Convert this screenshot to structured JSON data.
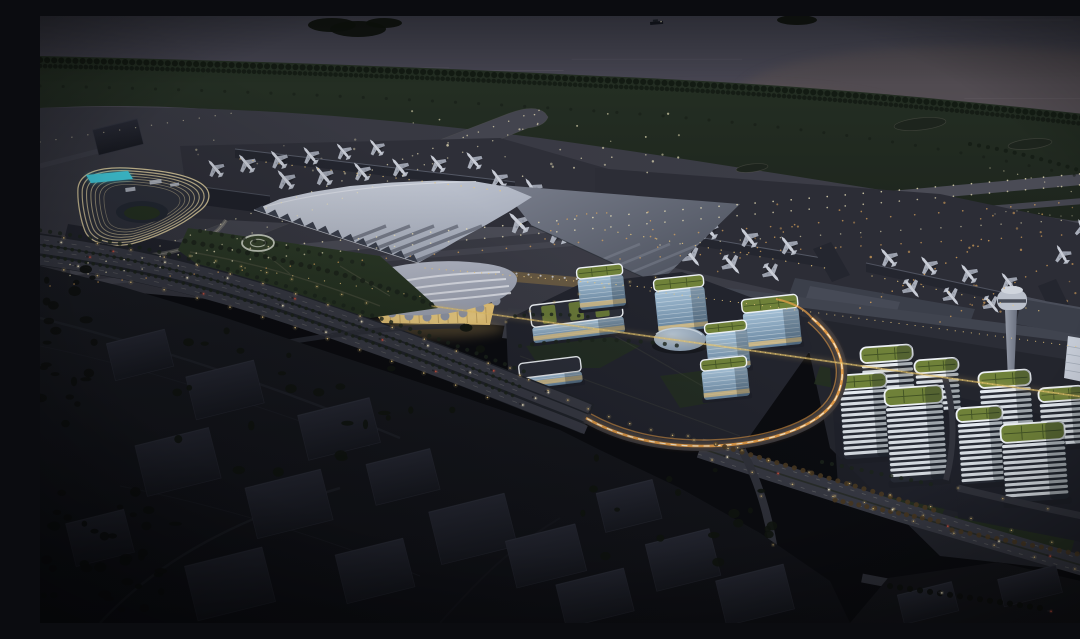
{
  "scene": {
    "title": "Aerial night rendering of a coastal airport city",
    "description": "Dusk aerial architectural rendering: sea at top, tree-lined shore, lit runways and taxiways with parked aircraft, a swept-wing terminal roof, curved lit hotel with rooftop pool, glowing shell-shaped ground transport centre, glass office cluster, striped office towers with green roofs, control tower, light-trail interchange roads and dark foreground hills"
  },
  "palette": {
    "water_top": "#3f404c",
    "water_low": "#514d5a",
    "water_warm": "#5e534f",
    "island": "#10140f",
    "shore_tree": "#131a13",
    "grass_a": "#253024",
    "grass_b": "#1d241d",
    "airfield_a": "#35363f",
    "airfield_b": "#3e3f49",
    "runway": "#4a4b55",
    "taxiway": "#43444e",
    "apron_a": "#2e2f38",
    "apron_b": "#2c2d36",
    "strip_edge": "#6f6e64",
    "light_pale": "#eee4bb",
    "light_amber": "#dfa65c",
    "light_warm": "#e9c87e",
    "trail_orange": "#f0a44a",
    "trail_core": "#f9efd7",
    "roof_hi": "#ced3de",
    "roof_lo": "#99a0af",
    "roof_stripe": "#3b404d",
    "wing_hi": "#787d8b",
    "wing_lo": "#484d59",
    "pier": "#24262f",
    "pier_edge": "#5f6472",
    "glow_warm": "#d9b36a",
    "gtc_hi": "#bcc0cd",
    "gtc_lo": "#9298a8",
    "gtc_stripe": "#eceef4",
    "gtc_glass": "#e8c577",
    "hotel_dark": "#2d303a",
    "hotel_band": "#ead8a6",
    "pool": "#41cbdc",
    "park_a": "#2d3b28",
    "park_b": "#243020",
    "path_c": "#736e5b",
    "helipad_ring": "#ced3c5",
    "glass_hi": "#a4c0d6",
    "glass_lo": "#63809a",
    "glass_line": "#e2eaf0",
    "warm_floor": "#dcbf82",
    "green_roof": "#6f8139",
    "roof_grid": "#3a4a21",
    "roof_rim": "#edf1f5",
    "band_white": "#e4eaf0",
    "band_dark": "#262a34",
    "disc_hi": "#b3c2d0",
    "disc_lo": "#7e90a4",
    "shaft_hi": "#959ba8",
    "shaft_lo": "#6b7180",
    "cab": "#bac0cb",
    "hangar": "#3b3f4a",
    "white_bldg": "#c6ccd7",
    "ground_r": "#23252d",
    "road": "#383a44",
    "road_dark": "#31333c",
    "lane": "#a8a89e",
    "car_body": "#23252c",
    "car_head": "#f6eac9",
    "car_tail": "#cf5340",
    "hill_a": "#1a1c22",
    "hill_b": "#101116",
    "block_a": "#272934",
    "block_b": "#181a21",
    "block_edge": "#31343f",
    "tree_dark": "#0e110e",
    "tree_warm": "#4a3a22",
    "tree_green": "#1c241b",
    "landside": "#2b2d36",
    "landside_roof": "#40444f",
    "red_marker": "#c0443a"
  },
  "features": {
    "light_rows": [
      {
        "d": "M30,248.5 L1078,154.5",
        "c": "light_pale",
        "w": 1.6,
        "g": 18,
        "o": 0.8,
        "halo": false
      },
      {
        "d": "M30,259.5 L1078,165.5",
        "c": "light_pale",
        "w": 1.6,
        "g": 18,
        "o": 0.7,
        "halo": false
      },
      {
        "d": "M10,270 L1078,182",
        "c": "light_amber",
        "w": 1.6,
        "g": 24,
        "o": 0.7,
        "halo": false
      },
      {
        "d": "M120,230 L500,94",
        "c": "light_pale",
        "w": 1.4,
        "g": 16,
        "o": 0.7,
        "halo": false
      },
      {
        "d": "M152,240 L512,102",
        "c": "light_pale",
        "w": 1.4,
        "g": 16,
        "o": 0.6,
        "halo": false
      },
      {
        "d": "M580,243 L1078,216",
        "c": "light_amber",
        "w": 1.5,
        "g": 20,
        "o": 0.7,
        "halo": false
      },
      {
        "d": "M620,229 L1078,201",
        "c": "light_pale",
        "w": 1.4,
        "g": 20,
        "o": 0.6,
        "halo": false
      },
      {
        "d": "M700,242 L760,206",
        "c": "light_amber",
        "w": 1.4,
        "g": 10,
        "o": 0.8,
        "halo": false
      },
      {
        "d": "M820,292 L950,224",
        "c": "light_amber",
        "w": 1.5,
        "g": 12,
        "o": 0.8,
        "halo": false
      },
      {
        "d": "M900,306 L1010,248",
        "c": "light_amber",
        "w": 1.5,
        "g": 12,
        "o": 0.7,
        "halo": false
      },
      {
        "d": "M0,126 L200,96",
        "c": "light_pale",
        "w": 1.3,
        "g": 16,
        "o": 0.5,
        "halo": false
      },
      {
        "d": "M950,152 C1000,162 1040,177 1078,197",
        "c": "light_pale",
        "w": 1.3,
        "g": 14,
        "o": 0.55,
        "halo": false
      },
      {
        "d": "M955,198 C990,188 1005,206 1045,198 C1070,193 1075,205 1078,210",
        "c": "light_pale",
        "w": 1.2,
        "g": 11,
        "o": 0.5,
        "halo": false
      },
      {
        "d": "M505,223 Q520,195 570,197",
        "c": "light_amber",
        "w": 1.4,
        "g": 10,
        "o": 0.8,
        "halo": false
      },
      {
        "d": "M608,196 L618,232",
        "c": "light_amber",
        "w": 1.4,
        "g": 9,
        "o": 0.8,
        "halo": false
      },
      {
        "d": "M200,143 L470,176",
        "c": "light_warm",
        "w": 1.3,
        "g": 13,
        "o": 0.85,
        "halo": false
      },
      {
        "d": "M565,214 L785,252",
        "c": "light_warm",
        "w": 1.3,
        "g": 13,
        "o": 0.85,
        "halo": false
      },
      {
        "d": "M832,260 L1005,296",
        "c": "light_warm",
        "w": 1.3,
        "g": 13,
        "o": 0.8,
        "halo": false
      },
      {
        "d": "M385,252 L615,272",
        "c": "light_warm",
        "w": 1.2,
        "g": 7,
        "o": 0.9,
        "halo": false
      },
      {
        "d": "M610,275 L1078,336",
        "c": "light_warm",
        "w": 1.1,
        "g": 8,
        "o": 0.85,
        "halo": false
      },
      {
        "d": "M205,252 L390,282",
        "c": "light_warm",
        "w": 1.2,
        "g": 16,
        "o": 0.8,
        "halo": false
      },
      {
        "d": "M-10,217 C80,229 160,247 250,276 C340,306 420,336 484,361",
        "c": "light_warm",
        "w": 1.5,
        "g": 34,
        "o": 0.95,
        "halo": true
      },
      {
        "d": "M-10,249 C80,261 160,280 250,310 C340,340 420,370 476,393",
        "c": "light_warm",
        "w": 1.5,
        "g": 34,
        "o": 0.95,
        "halo": true
      },
      {
        "d": "M150,240 Q250,258 340,292",
        "c": "light_warm",
        "w": 1.3,
        "g": 26,
        "o": 0.9,
        "halo": true
      },
      {
        "d": "M470,352 Q560,412 700,432",
        "c": "light_warm",
        "w": 1.4,
        "g": 22,
        "o": 0.95,
        "halo": true
      },
      {
        "d": "M466,306 Q540,270 640,258",
        "c": "light_warm",
        "w": 1.2,
        "g": 26,
        "o": 0.8,
        "halo": true
      },
      {
        "d": "M648,420 C710,440 790,462 868,484 C944,506 1010,526 1080,546",
        "c": "light_warm",
        "w": 1.4,
        "g": 42,
        "o": 0.9,
        "halo": true
      },
      {
        "d": "M672,444 C730,462 800,482 876,506 C950,528 1010,546 1080,566",
        "c": "light_warm",
        "w": 1.4,
        "g": 42,
        "o": 0.9,
        "halo": true
      },
      {
        "d": "M702,434 C718,464 730,502 736,548",
        "c": "light_warm",
        "w": 1.3,
        "g": 50,
        "o": 0.8,
        "halo": true
      },
      {
        "d": "M918,472 C960,482 1010,494 1082,508",
        "c": "light_warm",
        "w": 1.3,
        "g": 46,
        "o": 0.8,
        "halo": true
      },
      {
        "d": "M795,480 Q850,492 905,504",
        "c": "light_warm",
        "w": 1.2,
        "g": 30,
        "o": 0.8,
        "halo": true
      },
      {
        "d": "M392,290 L1080,386",
        "c": "light_warm",
        "w": 1.2,
        "g": 5,
        "o": 0.75,
        "halo": false
      }
    ],
    "tree_rows": [
      {
        "d": "M0,44 C180,48 360,54 560,64 C760,72 920,88 1080,106",
        "c": "shore_tree",
        "w": 6,
        "g": 7,
        "o": 0.95
      },
      {
        "d": "M0,50 C180,54 360,60 560,70 C760,78 920,94 1080,112",
        "c": "shore_tree",
        "w": 4.5,
        "g": 5,
        "o": 0.85
      },
      {
        "d": "M0,70 C200,74 400,84 600,98 C800,114 950,138 1080,170",
        "c": "shore_tree",
        "w": 3,
        "g": 23,
        "o": 0.5
      },
      {
        "d": "M930,128 C980,136 1030,150 1080,168",
        "c": "shore_tree",
        "w": 4,
        "g": 9,
        "o": 0.7
      },
      {
        "d": "M-10,227.5 C80,239.5 160,257.5 250,287 C340,317 420,347 481,371",
        "c": "tree_green",
        "w": 3.5,
        "g": 7,
        "o": 0.9
      },
      {
        "d": "M-10,238 C80,250 160,268.5 250,298.5 C340,328.5 420,358.5 479,382",
        "c": "tree_green",
        "w": 3.5,
        "g": 7,
        "o": 0.9
      },
      {
        "d": "M-10,213 C80,225 160,243 252,272 C342,302 424,332 488,357",
        "c": "tree_green",
        "w": 4,
        "g": 10,
        "o": 0.8
      },
      {
        "d": "M145,225 Q220,238 300,258 Q350,272 395,290",
        "c": "tree_green",
        "w": 5,
        "g": 9,
        "o": 0.9
      },
      {
        "d": "M160,215 Q240,228 330,250",
        "c": "tree_green",
        "w": 4,
        "g": 11,
        "o": 0.7
      },
      {
        "d": "M676,428 C740,448 810,468 900,496",
        "c": "tree_warm",
        "w": 5,
        "g": 9,
        "o": 0.9
      },
      {
        "d": "M795,484 L902,506",
        "c": "tree_warm",
        "w": 5,
        "g": 8,
        "o": 0.9
      },
      {
        "d": "M912,514 L1038,538",
        "c": "tree_warm",
        "w": 5,
        "g": 9,
        "o": 0.85
      },
      {
        "d": "M782,446 L900,470",
        "c": "tree_green",
        "w": 4,
        "g": 10,
        "o": 0.8
      },
      {
        "d": "M850,570 L1000,592",
        "c": "tree_dark",
        "w": 6,
        "g": 10,
        "o": 0.9
      },
      {
        "d": "M480,330 Q560,318 640,330",
        "c": "tree_green",
        "w": 4,
        "g": 12,
        "o": 0.8
      },
      {
        "d": "M475,300 Q520,296 556,302",
        "c": "tree_green",
        "w": 3.5,
        "g": 9,
        "o": 0.8
      }
    ],
    "airplanes": [
      [
        175,
        152,
        -40,
        0.85
      ],
      [
        206,
        147,
        -40,
        0.9
      ],
      [
        238,
        143,
        -41,
        0.9
      ],
      [
        270,
        139,
        -39,
        0.85
      ],
      [
        303,
        135,
        -40,
        0.8
      ],
      [
        336,
        131,
        -39,
        0.8
      ],
      [
        245,
        163,
        -40,
        0.95
      ],
      [
        283,
        159,
        -40,
        0.95
      ],
      [
        321,
        155,
        -40,
        0.9
      ],
      [
        359,
        151,
        -39,
        0.9
      ],
      [
        397,
        147,
        -39,
        0.85
      ],
      [
        433,
        144,
        -40,
        0.85
      ],
      [
        458,
        162,
        -36,
        0.9
      ],
      [
        492,
        172,
        -34,
        0.95
      ],
      [
        524,
        184,
        -32,
        1.0
      ],
      [
        478,
        206,
        -44,
        1.05
      ],
      [
        517,
        216,
        -40,
        1.1
      ],
      [
        556,
        197,
        -36,
        1.0
      ],
      [
        588,
        199,
        -40,
        0.95
      ],
      [
        628,
        206,
        -40,
        0.95
      ],
      [
        668,
        213,
        -40,
        0.95
      ],
      [
        708,
        221,
        -38,
        0.95
      ],
      [
        748,
        229,
        -38,
        0.9
      ],
      [
        612,
        233,
        141,
        0.95
      ],
      [
        652,
        241,
        141,
        0.95
      ],
      [
        692,
        249,
        140,
        0.95
      ],
      [
        732,
        257,
        140,
        0.9
      ],
      [
        848,
        241,
        -40,
        0.9
      ],
      [
        888,
        249,
        -39,
        0.9
      ],
      [
        928,
        257,
        -38,
        0.9
      ],
      [
        968,
        265,
        -38,
        0.85
      ],
      [
        872,
        273,
        141,
        0.9
      ],
      [
        912,
        281,
        141,
        0.85
      ],
      [
        952,
        289,
        140,
        0.85
      ],
      [
        1022,
        238,
        -30,
        0.85
      ],
      [
        1056,
        262,
        150,
        0.8
      ],
      [
        1042,
        212,
        -22,
        0.8
      ]
    ],
    "striped_towers": [
      [
        820,
        330,
        52,
        58
      ],
      [
        874,
        343,
        44,
        52
      ],
      [
        798,
        358,
        48,
        84
      ],
      [
        844,
        371,
        58,
        94
      ],
      [
        938,
        355,
        52,
        64
      ],
      [
        998,
        371,
        46,
        58
      ],
      [
        916,
        391,
        46,
        76
      ],
      [
        960,
        407,
        64,
        78
      ]
    ],
    "glass_towers": [
      {
        "x": 489,
        "y": 284,
        "w": 92,
        "h": 38,
        "rot": -7,
        "kind": "slab"
      },
      {
        "x": 536,
        "y": 250,
        "w": 46,
        "h": 42,
        "rot": -6,
        "kind": "tower"
      },
      {
        "x": 613,
        "y": 261,
        "w": 50,
        "h": 54,
        "rot": -6,
        "kind": "tower"
      },
      {
        "x": 701,
        "y": 281,
        "w": 56,
        "h": 50,
        "rot": -6,
        "kind": "tower"
      },
      {
        "x": 664,
        "y": 306,
        "w": 42,
        "h": 48,
        "rot": -6,
        "kind": "tower"
      },
      {
        "x": 660,
        "y": 342,
        "w": 46,
        "h": 40,
        "rot": -6,
        "kind": "tower"
      },
      {
        "x": 478,
        "y": 344,
        "w": 62,
        "h": 26,
        "rot": -7,
        "kind": "low"
      }
    ],
    "city_blocks": [
      [
        70,
        320,
        60,
        38
      ],
      [
        150,
        352,
        70,
        44
      ],
      [
        262,
        390,
        74,
        46
      ],
      [
        100,
        420,
        76,
        52
      ],
      [
        210,
        462,
        78,
        52
      ],
      [
        330,
        440,
        66,
        42
      ],
      [
        394,
        486,
        78,
        54
      ],
      [
        300,
        530,
        70,
        50
      ],
      [
        470,
        516,
        72,
        48
      ],
      [
        560,
        470,
        58,
        40
      ],
      [
        610,
        520,
        66,
        48
      ],
      [
        680,
        556,
        70,
        46
      ],
      [
        150,
        540,
        80,
        56
      ],
      [
        30,
        500,
        60,
        44
      ],
      [
        520,
        560,
        70,
        44
      ],
      [
        55,
        108,
        46,
        26
      ],
      [
        860,
        572,
        56,
        30
      ],
      [
        960,
        556,
        60,
        28
      ]
    ],
    "cars": [
      {
        "p": "P1n",
        "t": 0.05,
        "c": "w"
      },
      {
        "p": "P1n",
        "t": 0.14,
        "c": "r"
      },
      {
        "p": "P1n",
        "t": 0.23,
        "c": "w"
      },
      {
        "p": "P1n",
        "t": 0.34,
        "c": "w"
      },
      {
        "p": "P1n",
        "t": 0.46,
        "c": "r"
      },
      {
        "p": "P1n",
        "t": 0.58,
        "c": "w"
      },
      {
        "p": "P1n",
        "t": 0.7,
        "c": "w"
      },
      {
        "p": "P1n",
        "t": 0.82,
        "c": "r"
      },
      {
        "p": "P1n",
        "t": 0.92,
        "c": "w"
      },
      {
        "p": "P1c",
        "t": 0.1,
        "c": "r"
      },
      {
        "p": "P1c",
        "t": 0.27,
        "c": "w"
      },
      {
        "p": "P1c",
        "t": 0.44,
        "c": "w"
      },
      {
        "p": "P1c",
        "t": 0.62,
        "c": "r"
      },
      {
        "p": "P1c",
        "t": 0.78,
        "c": "w"
      },
      {
        "p": "P1c",
        "t": 0.9,
        "c": "w"
      },
      {
        "p": "P1s",
        "t": 0.08,
        "c": "w"
      },
      {
        "p": "P1s",
        "t": 0.3,
        "c": "r"
      },
      {
        "p": "P1s",
        "t": 0.52,
        "c": "w"
      },
      {
        "p": "P1s",
        "t": 0.72,
        "c": "r"
      },
      {
        "p": "P1s",
        "t": 0.88,
        "c": "w"
      },
      {
        "p": "R3",
        "t": 0.06,
        "c": "w"
      },
      {
        "p": "R3",
        "t": 0.18,
        "c": "r"
      },
      {
        "p": "R3",
        "t": 0.3,
        "c": "w"
      },
      {
        "p": "R3",
        "t": 0.45,
        "c": "w"
      },
      {
        "p": "R3",
        "t": 0.58,
        "c": "r"
      },
      {
        "p": "R3",
        "t": 0.7,
        "c": "w"
      },
      {
        "p": "R3",
        "t": 0.82,
        "c": "r"
      },
      {
        "p": "R3",
        "t": 0.93,
        "c": "w"
      },
      {
        "p": "R6",
        "t": 0.3,
        "c": "w"
      },
      {
        "p": "R6",
        "t": 0.72,
        "c": "r"
      }
    ],
    "scatter_lights": [
      {
        "x": 350,
        "y": 95,
        "w": 290,
        "h": 110,
        "n": 46,
        "c": "light_pale",
        "o": 0.75
      },
      {
        "x": 660,
        "y": 185,
        "w": 390,
        "h": 115,
        "n": 40,
        "c": "light_amber",
        "o": 0.7
      },
      {
        "x": 150,
        "y": 120,
        "w": 190,
        "h": 80,
        "n": 18,
        "c": "light_pale",
        "o": 0.5
      }
    ],
    "parking": {
      "x": 480,
      "y": 301,
      "cols": 8,
      "rows": 3,
      "dx": 9.5,
      "dy": 9.5,
      "rot": -7
    },
    "red_markers": [
      [
        587,
        247
      ],
      [
        621,
        250
      ]
    ],
    "islands": [
      [
        292,
        9,
        24,
        7
      ],
      [
        318,
        13,
        28,
        8
      ],
      [
        344,
        7,
        18,
        5
      ],
      [
        757,
        4,
        20,
        5
      ]
    ],
    "hotel_band_scales": [
      1,
      0.93,
      0.86,
      0.79,
      0.72,
      0.65,
      0.58
    ]
  }
}
